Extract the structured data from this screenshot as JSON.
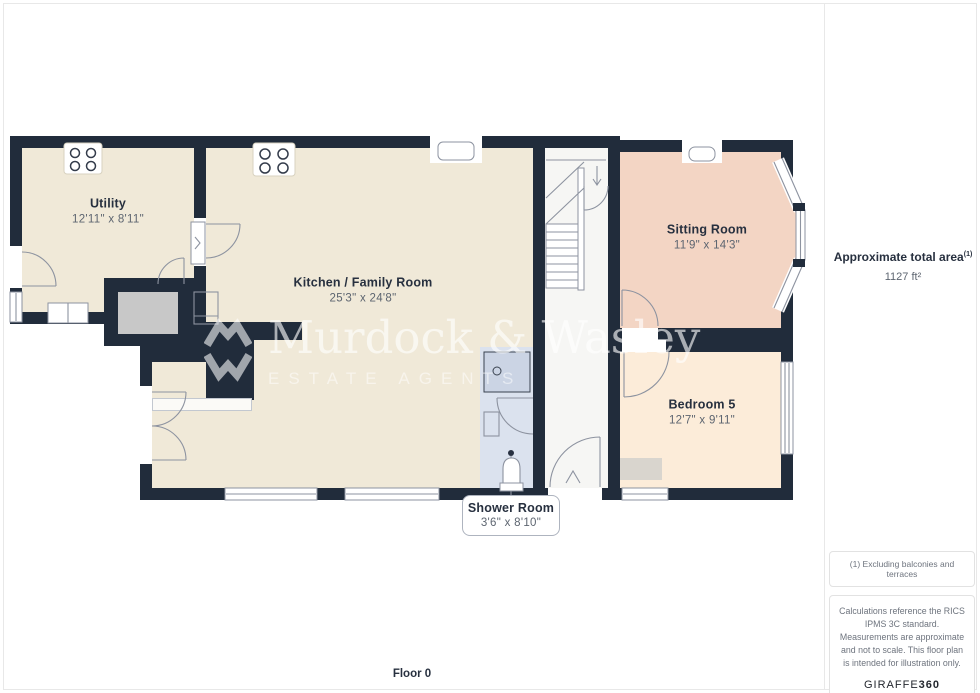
{
  "rooms": [
    {
      "name": "Utility",
      "dims": "12'11\" x 8'11\""
    },
    {
      "name": "Kitchen / Family Room",
      "dims": "25'3\" x 24'8\""
    },
    {
      "name": "Sitting Room",
      "dims": "11'9\" x 14'3\""
    },
    {
      "name": "Bedroom 5",
      "dims": "12'7\" x 9'11\""
    },
    {
      "name": "Shower Room",
      "dims": "3'6\" x 8'10\""
    }
  ],
  "watermark": {
    "brand": "Murdock & Wasley",
    "tagline": "ESTATE AGENTS"
  },
  "sidebar": {
    "area_label": "Approximate total area",
    "area_sup": "(1)",
    "area_value": "1127 ft²",
    "footnote": "(1) Excluding balconies and terraces",
    "disclaimer": "Calculations reference the RICS IPMS 3C standard. Measurements are approximate and not to scale. This floor plan is intended for illustration only.",
    "brand": "GIRAFFE",
    "brand_suffix": "360"
  },
  "footer": {
    "floor_label": "Floor 0"
  },
  "colors": {
    "wall": "#212c3b",
    "cream": "#f0e9d8",
    "salmon": "#f3d5c4",
    "peach": "#fcecd9",
    "shower": "#dbe2ee",
    "hall": "#f6f6f4",
    "chimney": "#c8c8c8",
    "mat": "#d9d5ce",
    "line": "#8d93a0",
    "navy": "#27303f",
    "dim": "#5d6570",
    "muted": "#6e747e",
    "divider": "#e8e8e8"
  }
}
